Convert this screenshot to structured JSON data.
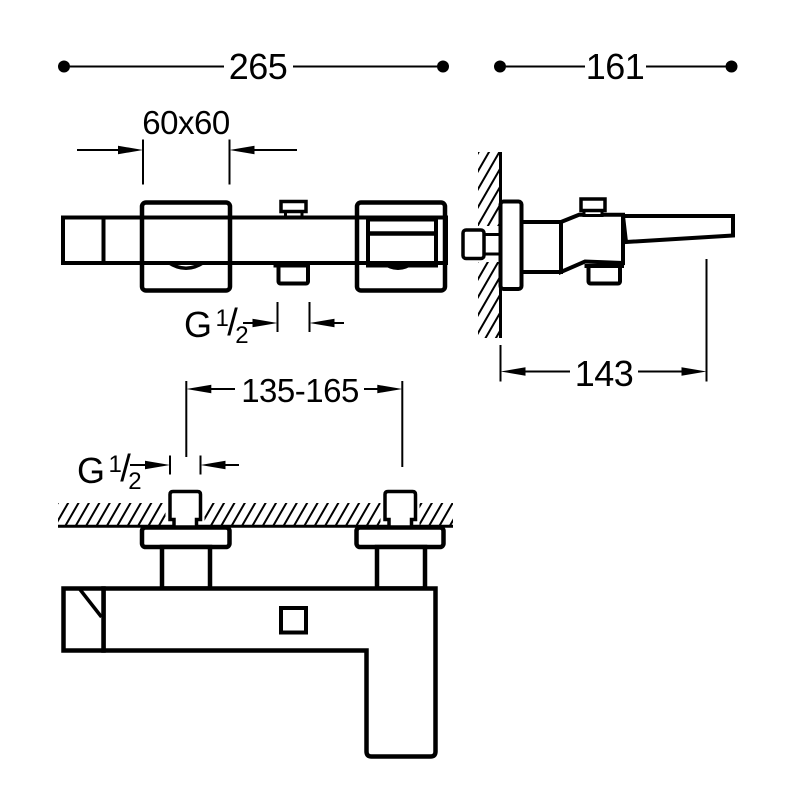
{
  "document": {
    "type": "technical-dimension-drawing",
    "subject": "wall-mounted bath mixer tap, three views",
    "background_color": "#ffffff",
    "line_color": "#000000"
  },
  "dimensions": {
    "overall_width": "265",
    "total_projection": "161",
    "escutcheon_size": "60x60",
    "spout_projection": "143",
    "inlet_spacing": "135-165",
    "outlet_thread": {
      "prefix": "G",
      "numerator": "1",
      "slash": "/",
      "denominator": "2"
    },
    "inlet_thread": {
      "prefix": "G",
      "numerator": "1",
      "slash": "/",
      "denominator": "2"
    }
  }
}
